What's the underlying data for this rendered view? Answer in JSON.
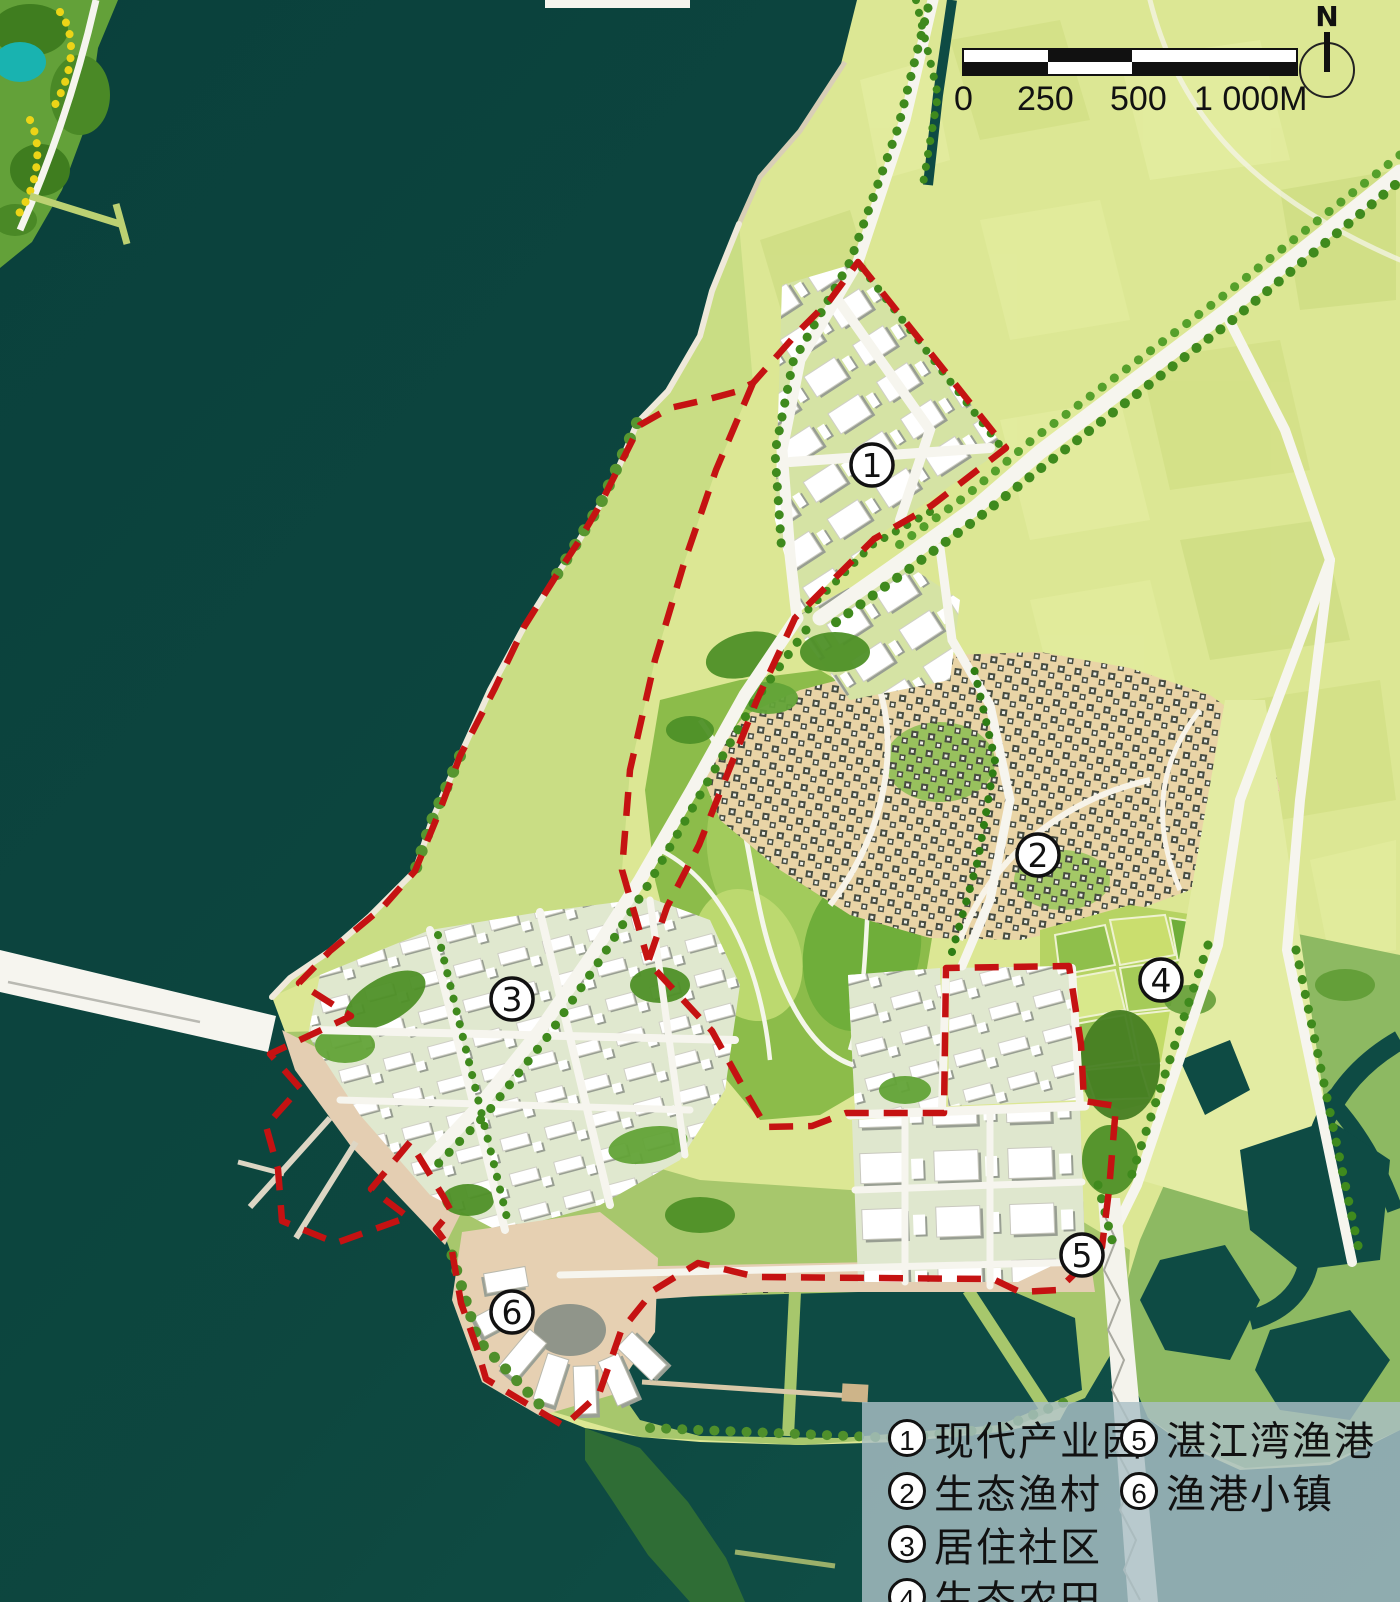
{
  "map_title": "湛江湾 coastal masterplan",
  "scale_bar": {
    "labels": [
      "0",
      "250",
      "500",
      "1 000M"
    ]
  },
  "compass": {
    "label": "N"
  },
  "markers": [
    {
      "num": "1"
    },
    {
      "num": "2"
    },
    {
      "num": "3"
    },
    {
      "num": "4"
    },
    {
      "num": "5"
    },
    {
      "num": "6"
    }
  ],
  "legend": {
    "items": [
      {
        "num": "1",
        "label": "现代产业园"
      },
      {
        "num": "2",
        "label": "生态渔村"
      },
      {
        "num": "3",
        "label": "居住社区"
      },
      {
        "num": "4",
        "label": "生态农田"
      },
      {
        "num": "5",
        "label": "湛江湾渔港"
      },
      {
        "num": "6",
        "label": "渔港小镇"
      }
    ]
  },
  "colors": {
    "water": "#0c4540",
    "pale_fields": "#dce794",
    "coastal_green": "#c9dd84",
    "park_green": "#8cbc4a",
    "village_ground": "#e9d4a6",
    "promenade": "#e4ceb2",
    "road": "#f6f5ee",
    "tree": "#3f8a1d",
    "boundary_red": "#c51212",
    "legend_bg": "rgba(171,191,198,0.82)"
  }
}
